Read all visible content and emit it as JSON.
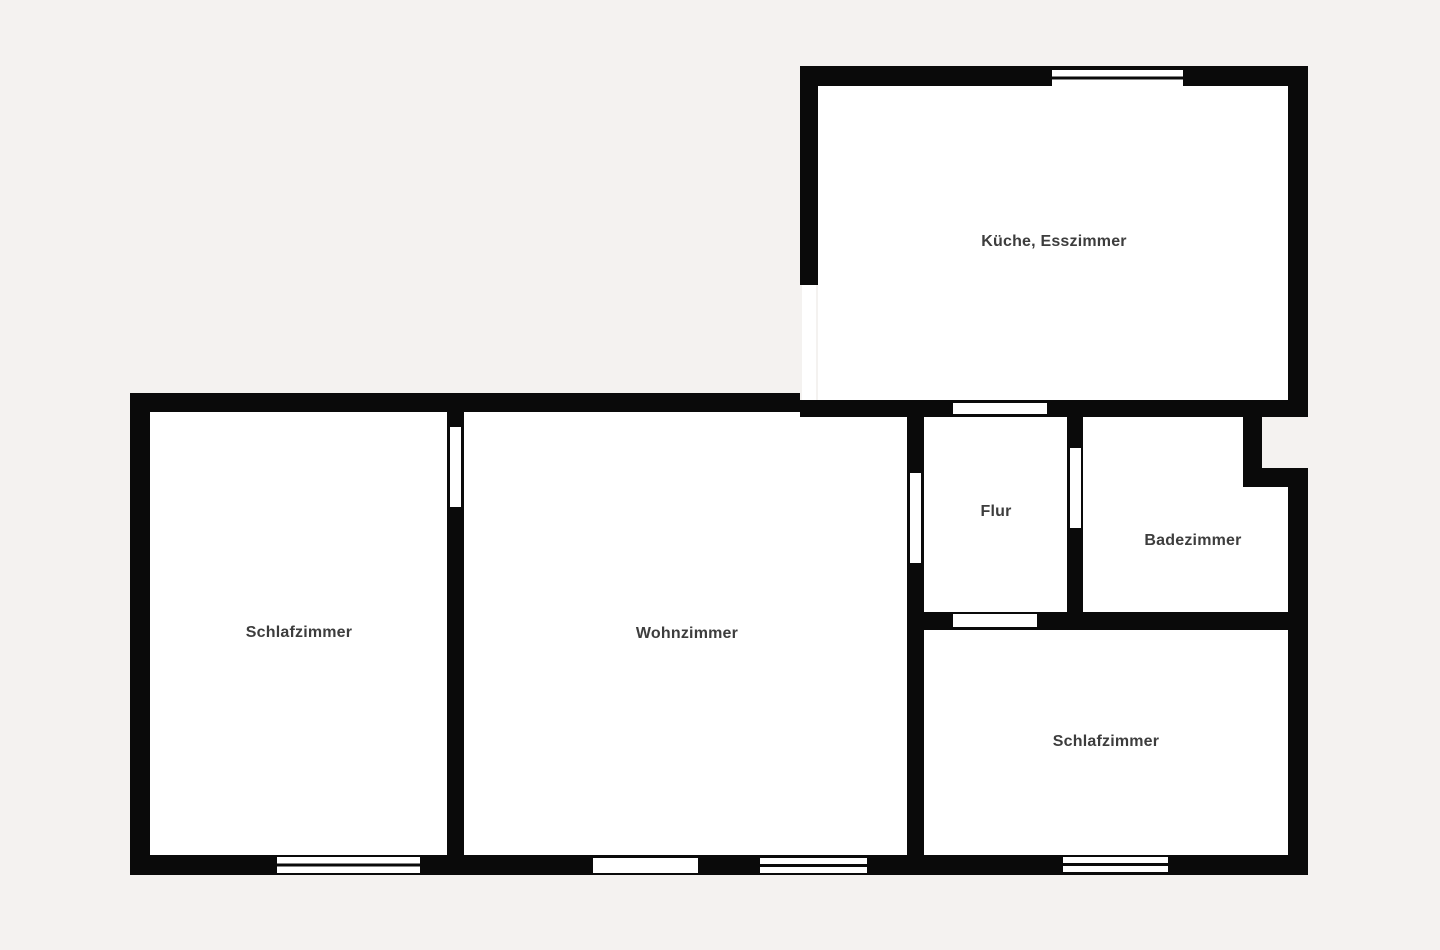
{
  "floorplan": {
    "type": "apartment-floor-plan",
    "colors": {
      "background": "#f4f2f0",
      "wall": "#0a0a0a",
      "room_fill": "#ffffff",
      "label": "#3d3d3d"
    },
    "rooms": [
      {
        "id": "kitchen-dining",
        "label": "Küche, Esszimmer"
      },
      {
        "id": "bedroom-left",
        "label": "Schlafzimmer"
      },
      {
        "id": "living-room",
        "label": "Wohnzimmer"
      },
      {
        "id": "hallway",
        "label": "Flur"
      },
      {
        "id": "bathroom",
        "label": "Badezimmer"
      },
      {
        "id": "bedroom-right",
        "label": "Schlafzimmer"
      }
    ]
  }
}
